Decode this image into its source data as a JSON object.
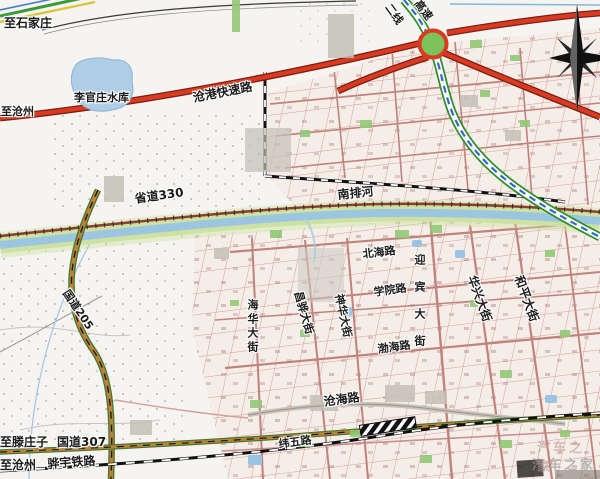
{
  "map": {
    "labels": {
      "to_shijiazhuang": "至石家庄",
      "canggang_expressway": "沧港快速路",
      "to_cangzhou_west": "至沧州",
      "liguanzhuang_reservoir": "李官庄水库",
      "erxian": "二线",
      "gaosu": "高速",
      "shengdao_330": "省道330",
      "nanpai_river": "南排河",
      "beihai_road": "北海路",
      "xueyuan_road": "学院路",
      "yingbin_street": "迎宾大街",
      "huaxing_street": "华兴大街",
      "heping_street": "和平大街",
      "shenhua_street": "神华大街",
      "changhua_street": "昌骅大街",
      "haihua_street": "海华大街",
      "bohai_road": "渤海路",
      "guodao_205": "国道205",
      "canghai_road": "沧海路",
      "weiwu_road": "纬五路",
      "to_tengzhuangzi": "至滕庄子",
      "guodao_307": "国道307",
      "to_cangzhou_south": "至沧州",
      "huayu_railway": "骅宇铁路"
    },
    "watermark": {
      "line1": "汽车之家",
      "line2": "汽车之家"
    },
    "colors": {
      "paper": "#f6f4f1",
      "road_red": "#d93a22",
      "road_red_casing": "#7d1f12",
      "road_orange": "#c08038",
      "road_green_edge": "#3a7a2e",
      "expwy_green": "#2f8f2f",
      "expwy_blue": "#3a66c8",
      "river_water": "#9cc6e0",
      "river_bank": "#cde2a2",
      "grid_pink": "#d4a09a",
      "street_pink": "#c0837c",
      "interchange_green": "#7dc35c",
      "s330_brown": "#8a4030",
      "label_ink": "#1b1b1b",
      "watermark_gray": "#9a9a9a"
    }
  }
}
